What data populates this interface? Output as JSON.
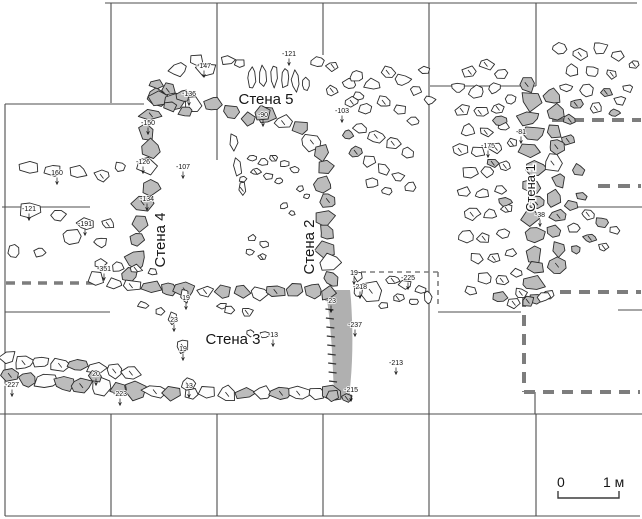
{
  "plan": {
    "wall_labels": [
      {
        "id": "wall-5",
        "text": "Стена 5",
        "x": 266,
        "y": 104,
        "rotate": 0,
        "size": 15
      },
      {
        "id": "wall-4",
        "text": "Стена 4",
        "x": 165,
        "y": 240,
        "rotate": -90,
        "size": 15
      },
      {
        "id": "wall-2",
        "text": "Стена 2",
        "x": 314,
        "y": 247,
        "rotate": -90,
        "size": 15
      },
      {
        "id": "wall-3",
        "text": "Стена 3",
        "x": 233,
        "y": 344,
        "rotate": 0,
        "size": 15
      },
      {
        "id": "wall-1",
        "text": "Стена 1",
        "x": 535,
        "y": 188,
        "rotate": -90,
        "size": 13
      }
    ],
    "elevation_markers": [
      {
        "t": "-147",
        "x": 204,
        "y": 68
      },
      {
        "t": "-136",
        "x": 189,
        "y": 96
      },
      {
        "t": "-121",
        "x": 289,
        "y": 56
      },
      {
        "t": "-90",
        "x": 263,
        "y": 117
      },
      {
        "t": "-103",
        "x": 342,
        "y": 113
      },
      {
        "t": "-150",
        "x": 148,
        "y": 125
      },
      {
        "t": "-126",
        "x": 143,
        "y": 164
      },
      {
        "t": "-107",
        "x": 183,
        "y": 169
      },
      {
        "t": "-134",
        "x": 147,
        "y": 201
      },
      {
        "t": "160",
        "x": 57,
        "y": 175
      },
      {
        "t": "-121",
        "x": 29,
        "y": 211
      },
      {
        "t": "-191",
        "x": 85,
        "y": 226
      },
      {
        "t": "-351",
        "x": 104,
        "y": 271
      },
      {
        "t": "-81",
        "x": 521,
        "y": 134
      },
      {
        "t": "-175",
        "x": 488,
        "y": 148
      },
      {
        "t": "-38",
        "x": 540,
        "y": 217
      },
      {
        "t": "19",
        "x": 354,
        "y": 275
      },
      {
        "t": "-218",
        "x": 360,
        "y": 289
      },
      {
        "t": "-225",
        "x": 408,
        "y": 280
      },
      {
        "t": "-23",
        "x": 331,
        "y": 303
      },
      {
        "t": "-237",
        "x": 355,
        "y": 327
      },
      {
        "t": "-213",
        "x": 396,
        "y": 365
      },
      {
        "t": "-215",
        "x": 351,
        "y": 392
      },
      {
        "t": "-227",
        "x": 12,
        "y": 387
      },
      {
        "t": "-223",
        "x": 120,
        "y": 396
      },
      {
        "t": "20",
        "x": 96,
        "y": 376
      },
      {
        "t": "13",
        "x": 189,
        "y": 388
      },
      {
        "t": "-13",
        "x": 273,
        "y": 337
      },
      {
        "t": "19",
        "x": 186,
        "y": 300
      },
      {
        "t": "23",
        "x": 174,
        "y": 322
      },
      {
        "t": "19",
        "x": 183,
        "y": 351
      }
    ],
    "scale_bar": {
      "zero": "0",
      "unit": "1 м"
    },
    "colors": {
      "stone_gray": "#bcbcbc",
      "stone_white": "#fdfdfd",
      "stone_stroke": "#2b2b2b",
      "grid_line": "#4d4d4d",
      "dashed_line": "#7d7d7d",
      "wall_strip": "#b0b0b0"
    }
  }
}
